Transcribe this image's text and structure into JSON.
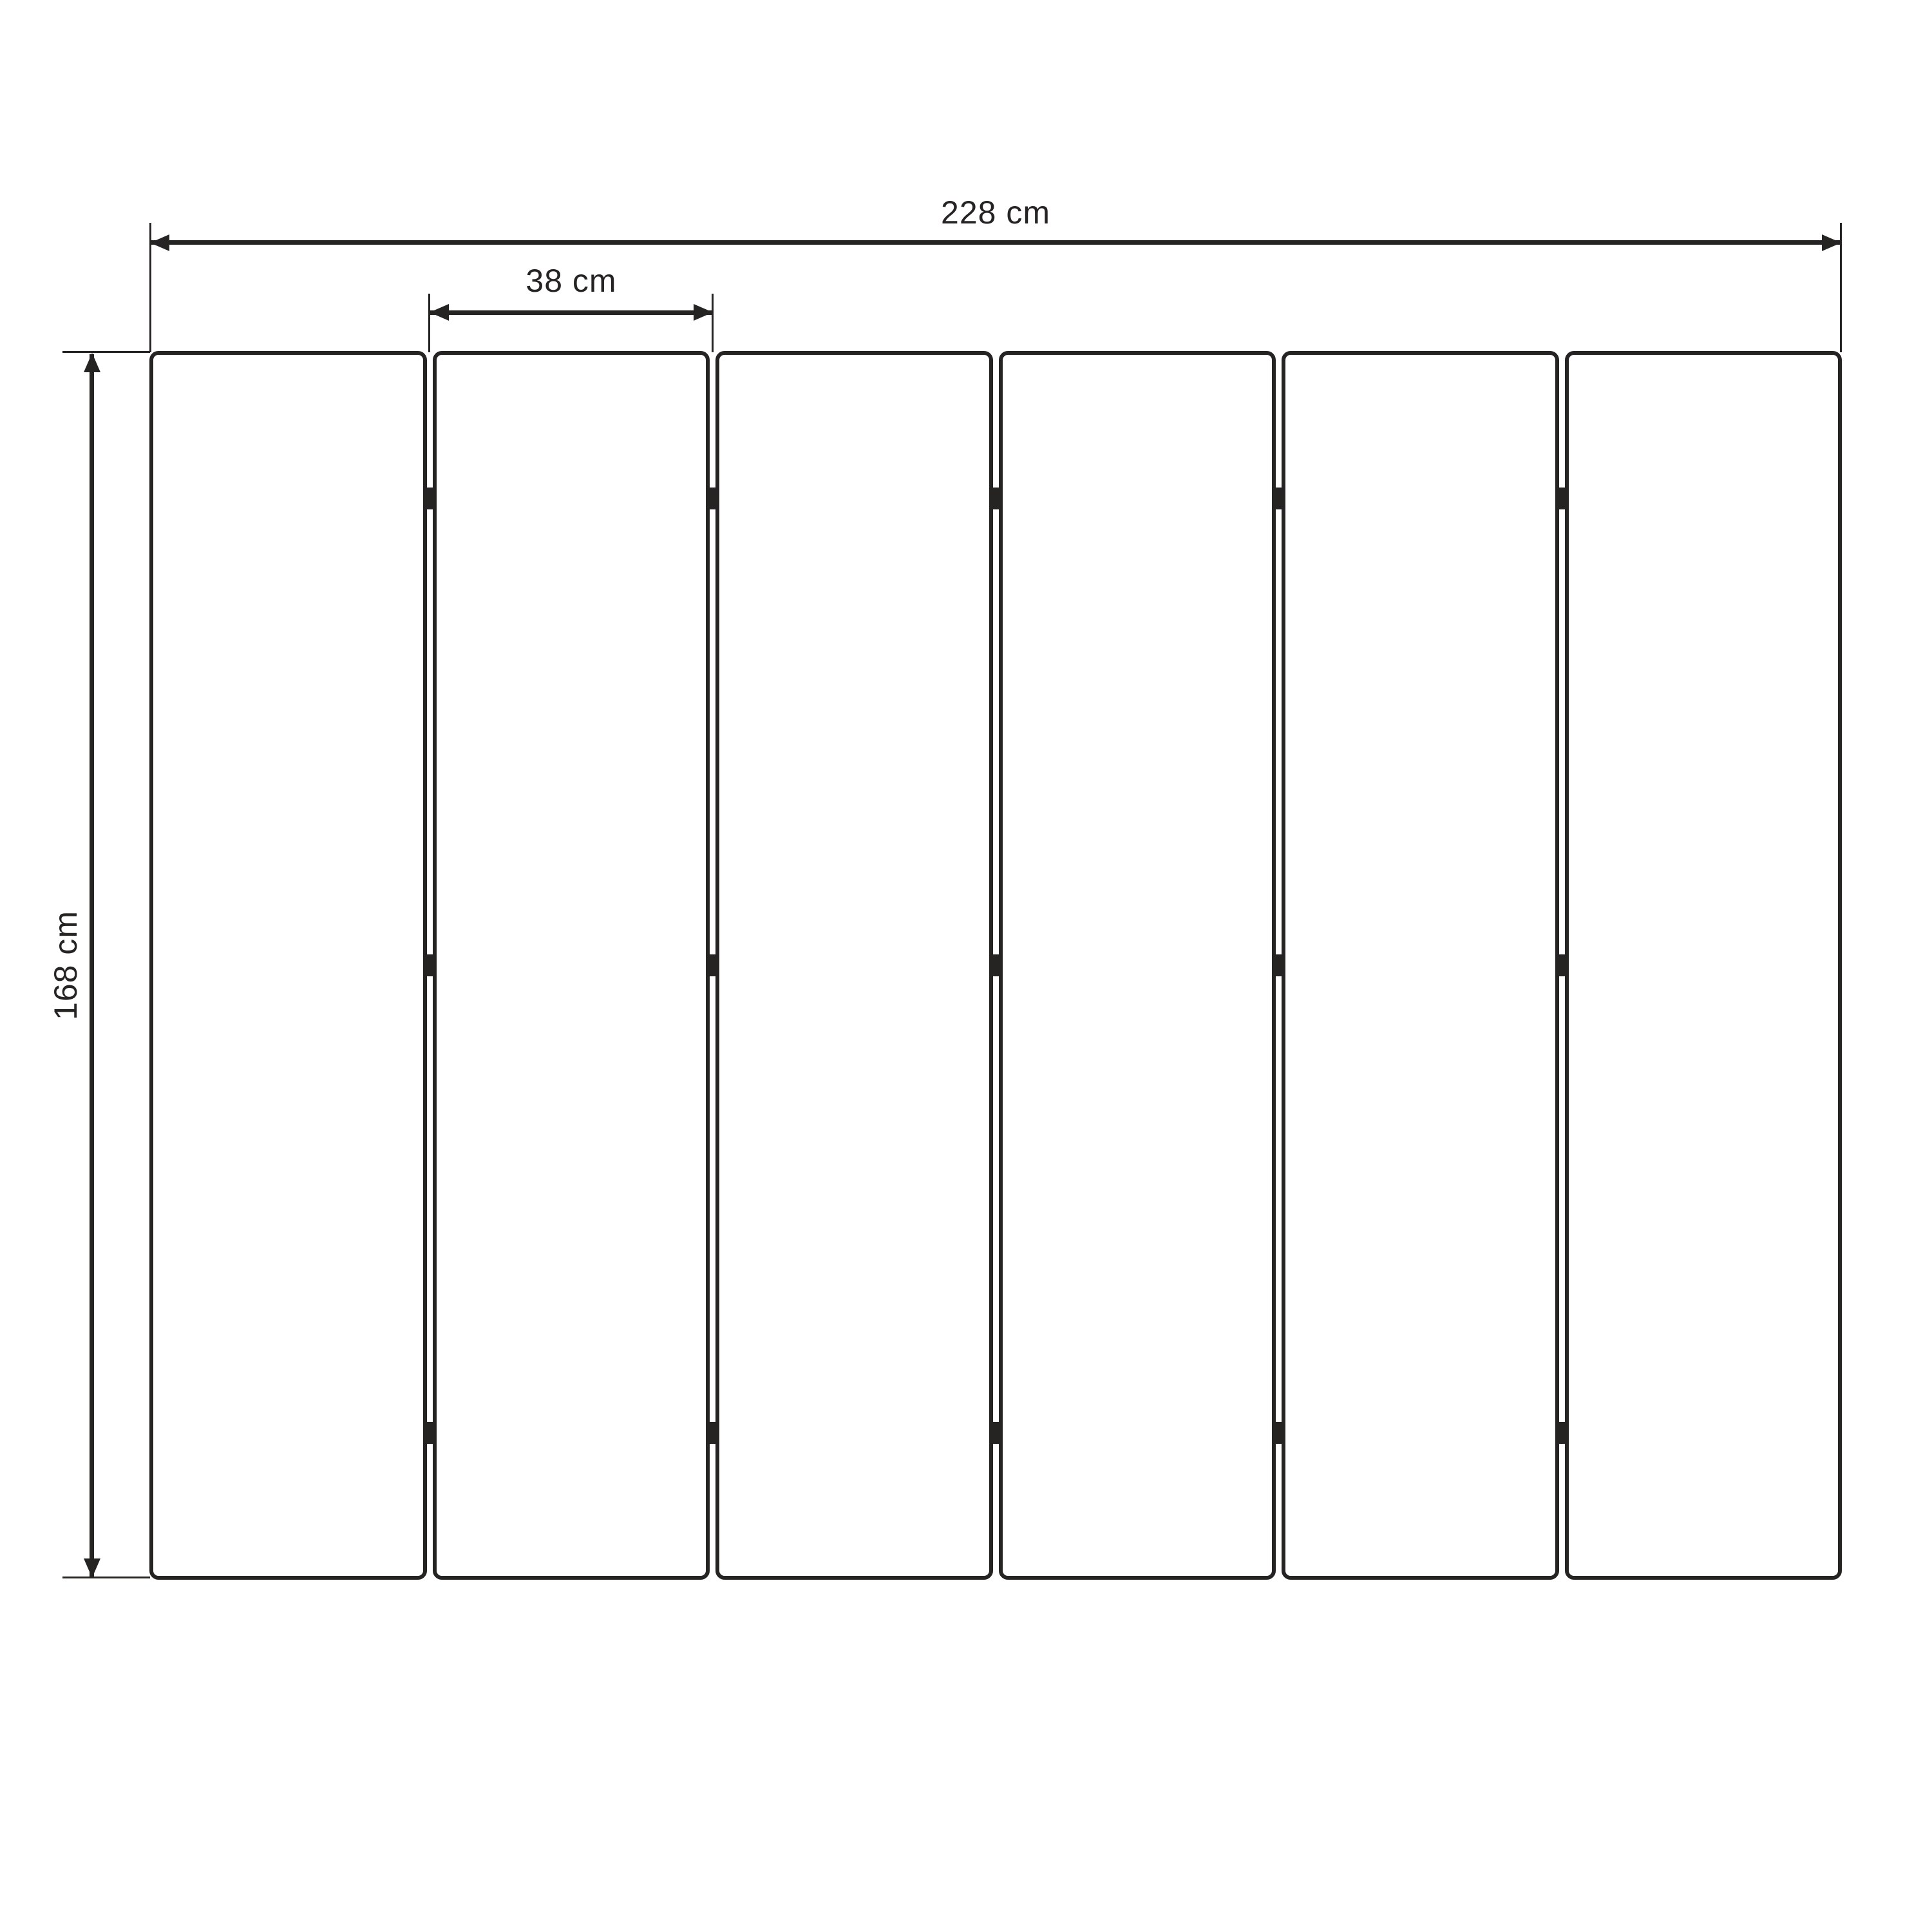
{
  "diagram": {
    "type": "technical-dimension-drawing",
    "subject": "six-panel folding screen, front elevation with dimensions",
    "colors": {
      "ink": "#262323",
      "background": "#ffffff",
      "panel_fill": "#ffffff"
    },
    "panels": {
      "count": 6,
      "hinge_joints": 5,
      "hinges_per_joint": 3
    },
    "dimensions": {
      "total_width": {
        "label": "228 cm",
        "value_cm": 228,
        "orientation": "horizontal"
      },
      "panel_width": {
        "label": "38 cm",
        "value_cm": 38,
        "orientation": "horizontal"
      },
      "height": {
        "label": "168 cm",
        "value_cm": 168,
        "orientation": "vertical"
      }
    }
  }
}
